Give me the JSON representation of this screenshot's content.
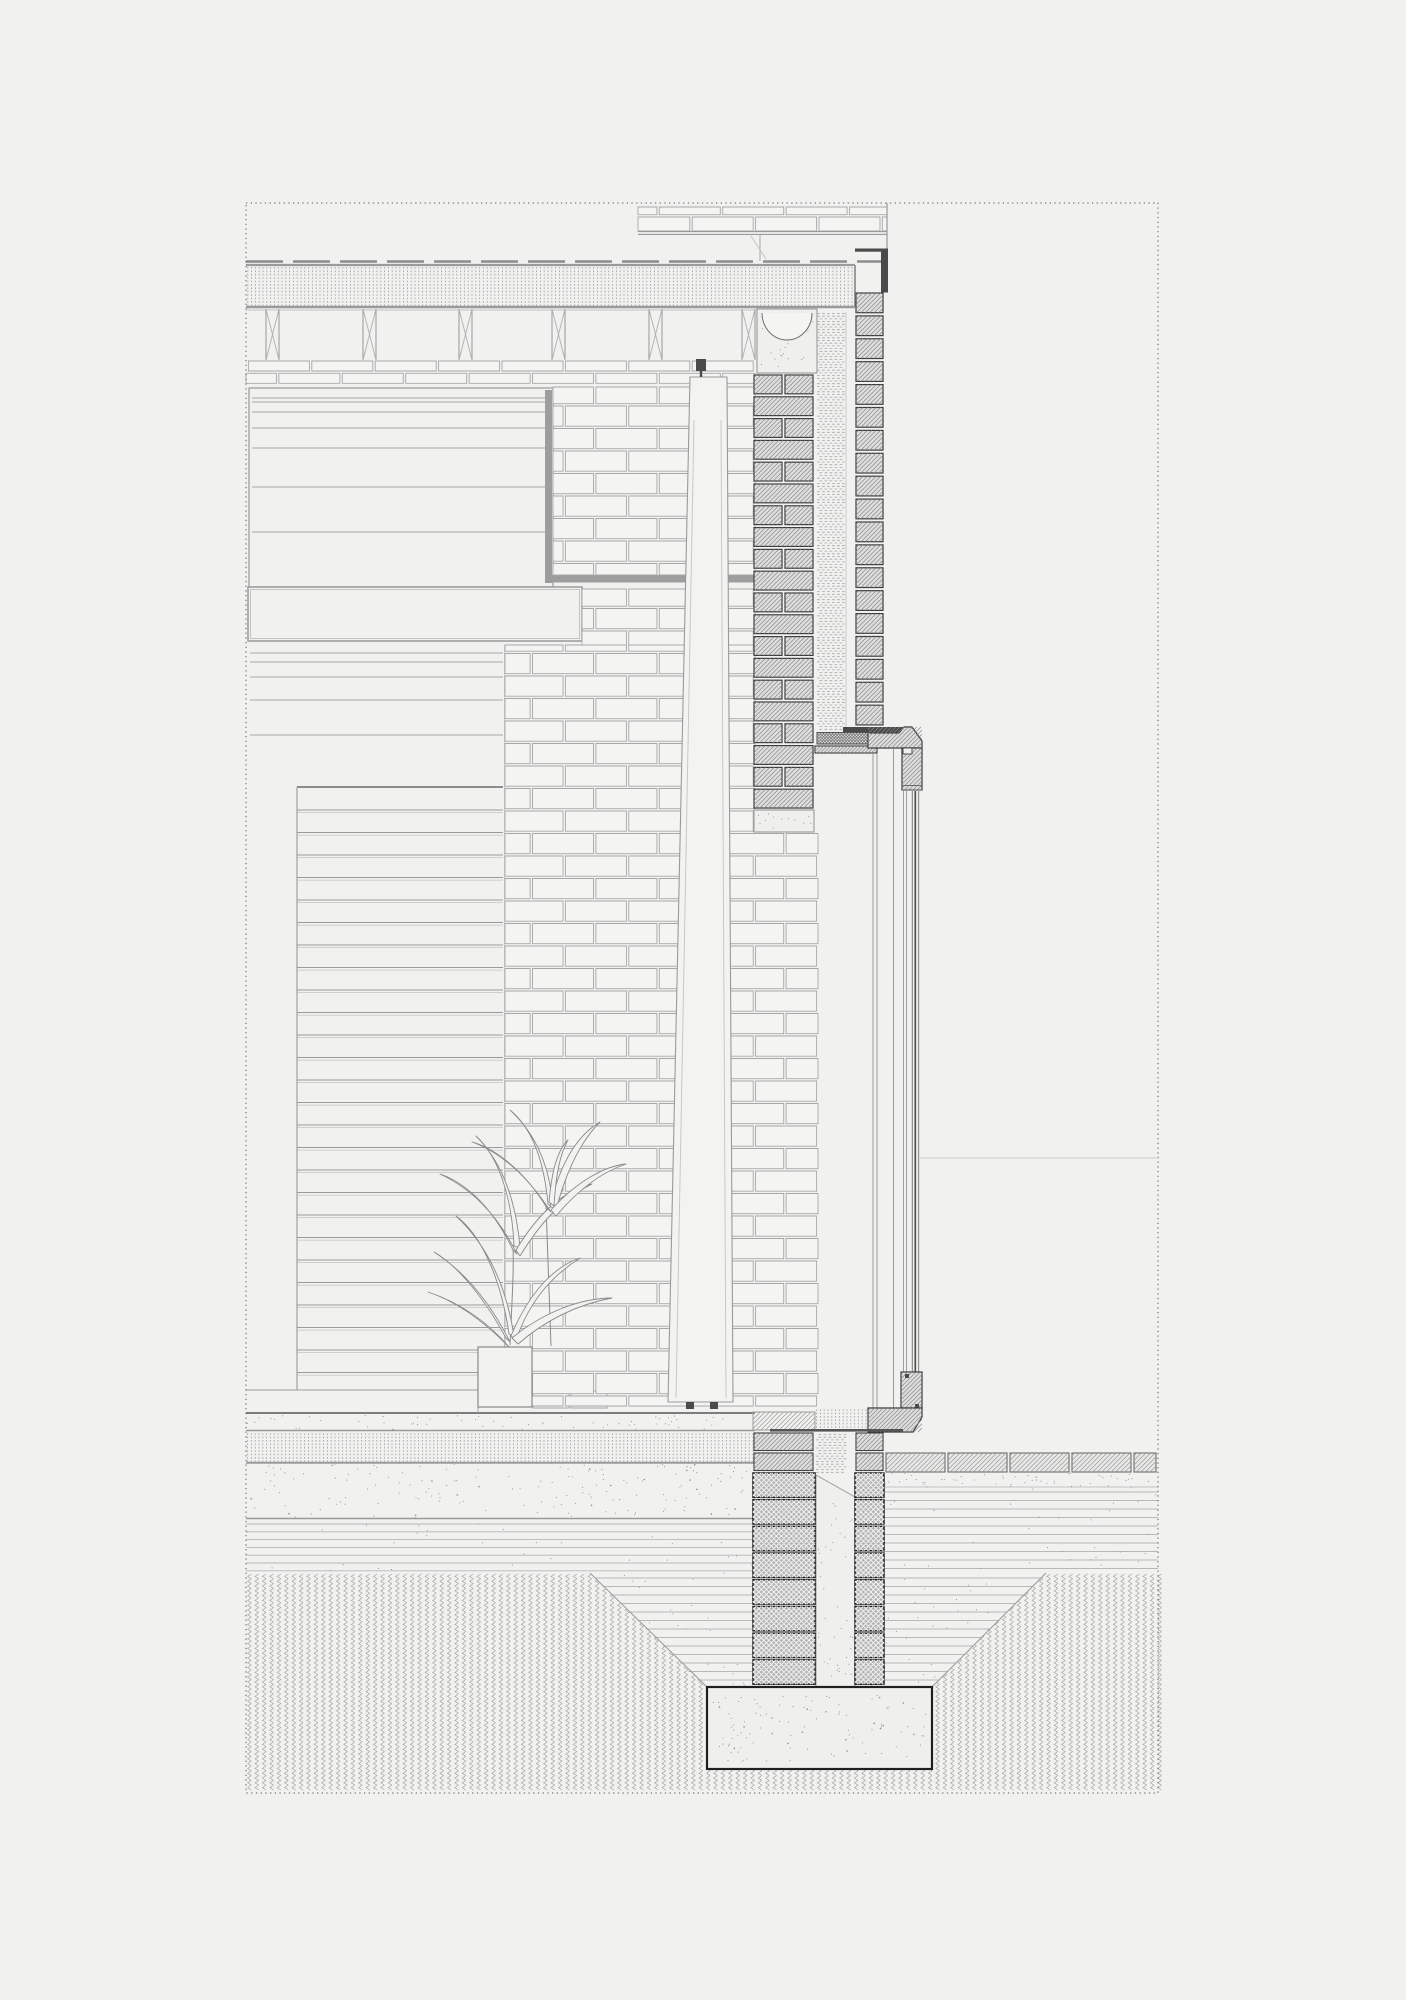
{
  "drawing": {
    "kind": "architectural-section-detail",
    "visible_text": [],
    "components": [
      "roof-membrane",
      "roof-insulation",
      "ceiling-joists",
      "parapet-brickwork",
      "metal-flashing",
      "interior-wall-paneling",
      "brick-elevation",
      "inner-brick-leaf",
      "cavity-insulation",
      "outer-brick-leaf",
      "window-head",
      "glazing-unit",
      "window-sill",
      "steel-lintel",
      "concrete-padstone",
      "potted-plant",
      "tapered-column",
      "floor-screed",
      "floor-insulation",
      "concrete-slab",
      "hardcore-layer",
      "paving-slabs",
      "foundation-walls",
      "concrete-footing",
      "excavation-backfill",
      "undisturbed-earth"
    ]
  },
  "colors": {
    "paper": "#f1f1f0",
    "line_light": "#c4c4c3",
    "line_mid": "#9a9a9a",
    "line_dark": "#6b6b6b",
    "near_black": "#2e2e2e",
    "brick_white": "#f4f4f3",
    "brick_outline": "#a8a8a8",
    "hatch_fill": "#dedede",
    "hatch_line": "#8a8a8a",
    "hatch_outline": "#3a3a3a",
    "cross_fill": "#b3b3b3",
    "cross_line": "#f2f2f2",
    "cross_outline": "#202020",
    "steel": "#4a4a4a",
    "track_bar": "#9d9d9d",
    "paver_fill": "#e8e8e7",
    "concrete": "#efefee",
    "stipple": "#8f8f8f",
    "chevron": "#a6a6a5",
    "hline": "#b8b8b8",
    "insulation": "#a8a8a8",
    "border_dot": "#5a5a5a"
  },
  "geo": {
    "canvas": {
      "w": 1406,
      "h": 2000
    },
    "border": {
      "x1": 246,
      "y1": 203,
      "x2": 1158,
      "y2": 1793
    },
    "roof": {
      "mem_y": 261.5,
      "mem_x1": 246,
      "mem_x2": 884,
      "ins": [
        246,
        265,
        609,
        42
      ],
      "ceil_thin_y": 310,
      "ceil_x2": 757
    },
    "parapet": {
      "x1": 638,
      "x2": 887,
      "bk_y1": 207,
      "bk_y2": 231,
      "dbl": [
        231.6,
        234.4
      ],
      "innerv": 760,
      "diag": [
        751,
        236,
        766,
        259
      ],
      "flash_h": [
        855,
        248.5,
        33,
        3.2
      ],
      "flash_v": [
        881,
        248.5,
        7,
        44
      ],
      "left_v": [
        638,
        203,
        261
      ],
      "right_v": [
        887,
        203,
        249
      ]
    },
    "joists": {
      "xs": [
        266,
        363,
        459,
        552,
        649,
        742
      ],
      "w": 13,
      "y1": 309,
      "y2": 360
    },
    "interior": {
      "panelA": {
        "x": 249,
        "y": 388,
        "x2": 553,
        "y2": 587,
        "lines": [
          398,
          402,
          412,
          428,
          448,
          487,
          532
        ]
      },
      "bar_v": [
        545,
        390,
        7,
        193
      ],
      "bar_h": [
        545,
        575,
        210,
        7.5
      ],
      "midPanel": [
        248,
        587,
        334,
        54
      ],
      "panelB": {
        "x": 250,
        "x2": 503,
        "lines": [
          653,
          662,
          677,
          700,
          735
        ],
        "bottom": [
          297,
          787,
          503
        ]
      },
      "planks": {
        "x1": 297,
        "x2": 503,
        "start": 810,
        "step": 22.5,
        "end": 1388
      },
      "leftv": [
        297,
        787,
        1390
      ],
      "skirt": {
        "y": 1390,
        "x1": 246,
        "x2": 505,
        "joint": 478
      },
      "boxes": [
        [
          533,
          1391,
          36,
          17
        ],
        [
          571,
          1391,
          36,
          17
        ]
      ]
    },
    "bricks": {
      "phase": 361,
      "ch": 22.5,
      "len": 61,
      "origin": 246,
      "regions": [
        [
          246,
          361,
          755,
          386,
          12.3
        ],
        [
          553,
          387,
          755,
          575
        ],
        [
          582,
          589,
          755,
          645
        ],
        [
          505,
          645,
          755,
          833
        ],
        [
          505,
          833,
          818,
          1406
        ]
      ],
      "parapet_region": [
        638,
        207,
        887,
        231,
        24
      ]
    },
    "wall": {
      "box": [
        757,
        309,
        60,
        64
      ],
      "box_arc": [
        762,
        313,
        812,
        368
      ],
      "inner_leaf": [
        754,
        375,
        813,
        810,
        21.8
      ],
      "padstone": [
        754,
        810,
        60,
        22
      ],
      "outer_leaf": [
        856,
        293,
        883,
        724,
        22.9
      ],
      "cavity_ins": [
        817,
        312,
        28,
        419
      ],
      "dpc": [
        817,
        732.5,
        55,
        11.5
      ],
      "steel": [
        843,
        727,
        64,
        5.5
      ],
      "steel_lip": [
        901.5,
        732.5,
        5.5,
        7
      ],
      "lining": [
        815,
        746,
        62,
        7
      ]
    },
    "window": {
      "head": "M868 733 L899 733 L904 727 L912 727 L922 741 L922 748 L868 748 Z",
      "frame": [
        902,
        748,
        20,
        42
      ],
      "frame_notch": [
        903,
        748,
        9,
        6
      ],
      "frame_lines": [
        785.5,
        790
      ],
      "glaze_y1": 791,
      "glaze_y2": 1372,
      "glaze_lines": [
        [
          903.5,
          "#9f9f9f",
          1
        ],
        [
          906.5,
          "#9f9f9f",
          1
        ],
        [
          912.3,
          "#787878",
          1
        ],
        [
          915.3,
          "#4f4f4f",
          1.7
        ],
        [
          918.6,
          "#8a8a8a",
          1.1
        ]
      ],
      "reveal": [
        [
          873,
          753,
          1412
        ],
        [
          877,
          753,
          1412
        ],
        [
          893.5,
          749,
          1408
        ]
      ],
      "rail": [
        901,
        1372,
        21,
        36
      ],
      "sill": "M868 1408 L922 1408 L922 1417 L913 1432 L868 1432 Z",
      "seal": [
        770,
        1429,
        133,
        2.6
      ],
      "ext_line": [
        920,
        1158,
        1156
      ]
    },
    "column": {
      "pts": "690,377 727,377 733,1402 668,1402",
      "inner": [
        [
          694,
          420,
          676,
          1398
        ],
        [
          721,
          420,
          726,
          1398
        ]
      ],
      "bracket": [
        696,
        359,
        10,
        12
      ],
      "stem": [
        701,
        371,
        701,
        377
      ],
      "feet": [
        [
          686,
          1402,
          8,
          7
        ],
        [
          710,
          1402,
          8,
          7
        ]
      ]
    },
    "plant": {
      "pot": [
        478,
        1347,
        54,
        60
      ],
      "stems": [
        "M510 1345 C512 1300 514 1270 513 1245",
        "M551 1346 C549 1290 547 1240 546 1205"
      ],
      "leaves": [
        "M506 1344 C478 1316 452 1300 428 1292 C458 1302 486 1320 510 1348 Z",
        "M506 1338 C480 1290 452 1262 434 1252 C462 1270 488 1298 510 1342 Z",
        "M509 1334 C500 1272 478 1232 456 1216 C486 1244 506 1284 514 1336 Z",
        "M511 1336 C530 1290 556 1266 580 1258 C552 1276 530 1300 516 1340 Z",
        "M512 1338 C546 1310 584 1298 612 1298 C580 1304 548 1318 518 1344 Z",
        "M513 1250 C492 1206 464 1182 440 1174 C470 1188 496 1212 517 1254 Z",
        "M514 1246 C512 1196 498 1156 476 1136 C502 1162 516 1200 520 1248 Z",
        "M516 1250 C540 1210 566 1190 592 1184 C564 1198 542 1220 520 1256 Z",
        "M547 1208 C524 1170 494 1148 472 1142 C500 1152 526 1174 551 1212 Z",
        "M548 1204 C544 1160 532 1128 510 1110 C536 1134 550 1166 553 1208 Z",
        "M550 1206 C560 1164 576 1136 600 1122 C580 1142 566 1172 556 1210 Z",
        "M551 1210 C578 1180 606 1166 626 1164 C602 1172 578 1190 556 1216 Z",
        "M549 1202 C552 1168 558 1150 568 1140 C560 1154 556 1174 554 1206 Z"
      ]
    },
    "ground": {
      "floor_y": 1413,
      "screed": [
        246,
        1415.5,
        509,
        14
      ],
      "ins": [
        246,
        1432,
        509,
        30
      ],
      "ins_lines": [
        1430.5,
        1462.5
      ],
      "slab": [
        246,
        1464,
        509,
        54
      ],
      "slab_lines": [
        1463,
        1518.5
      ],
      "hl_left": {
        "r": [
          246,
          1520,
          509,
          53
        ],
        "start": 1524,
        "step": 7.8
      },
      "hl_right": {
        "r": [
          884,
          1487,
          274,
          86
        ],
        "start": 1492,
        "step": 8.5
      },
      "bedding": [
        884,
        1473,
        274,
        14
      ],
      "pavers": {
        "y": 1453,
        "h": 19,
        "xs": [
          886,
          948,
          1010,
          1072,
          1134
        ],
        "w": 59,
        "xend": 1156
      },
      "sill_ins": [
        815,
        1408,
        55,
        22
      ],
      "floor_piece": [
        753,
        1412,
        62,
        18
      ],
      "trap": {
        "yt": 1573,
        "yb": 1687,
        "xl": 590,
        "xr": 1046,
        "fl": 707,
        "fr": 932
      },
      "chev": [
        246,
        1573,
        912,
        220
      ],
      "cavity_ins2": [
        816,
        1433,
        30,
        42
      ],
      "cavity_fill": "M816 1475 L855 1497 L855 1687 L816 1687 Z",
      "leaf_rows": [
        1433,
        1453
      ],
      "leaf_bh": 17.5,
      "leaf_in": [
        754,
        813
      ],
      "leaf_out": [
        856,
        883
      ],
      "cross_in": [
        753,
        815,
        1473,
        1687
      ],
      "cross_out": [
        855,
        884,
        1473,
        1687
      ],
      "cross_ch": 26.7,
      "footing": [
        707,
        1687,
        225,
        82
      ]
    }
  }
}
